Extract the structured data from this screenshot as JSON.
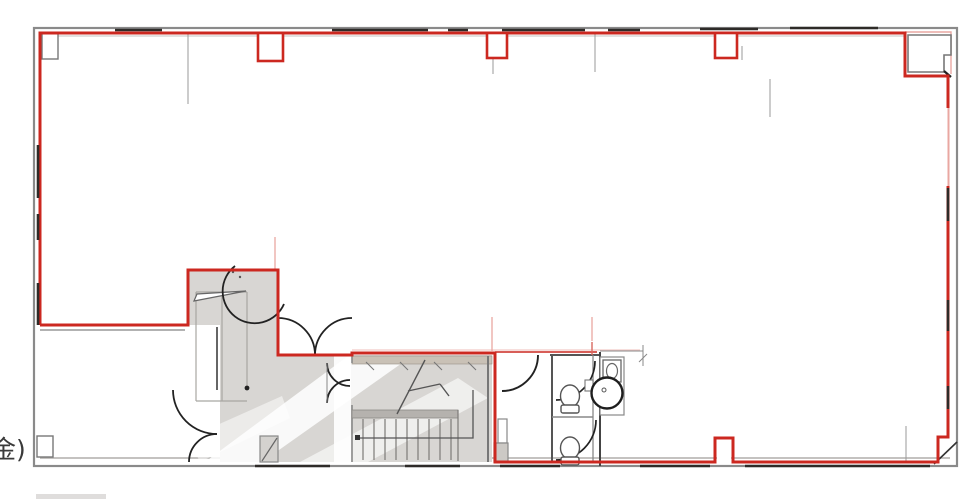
{
  "annotation": {
    "text": "金)"
  },
  "palette": {
    "lease_red": "#cc2820",
    "grid_pink": "#e9a7a2",
    "wall_gray": "#8a8a8a",
    "wall_dark": "#2e2b28",
    "core_fill": "#d8d6d3",
    "stair_top_wall": "#c9c1b6",
    "landing_gray": "#b5b2ae",
    "text_color": "#3a3a3a",
    "background": "#ffffff"
  }
}
